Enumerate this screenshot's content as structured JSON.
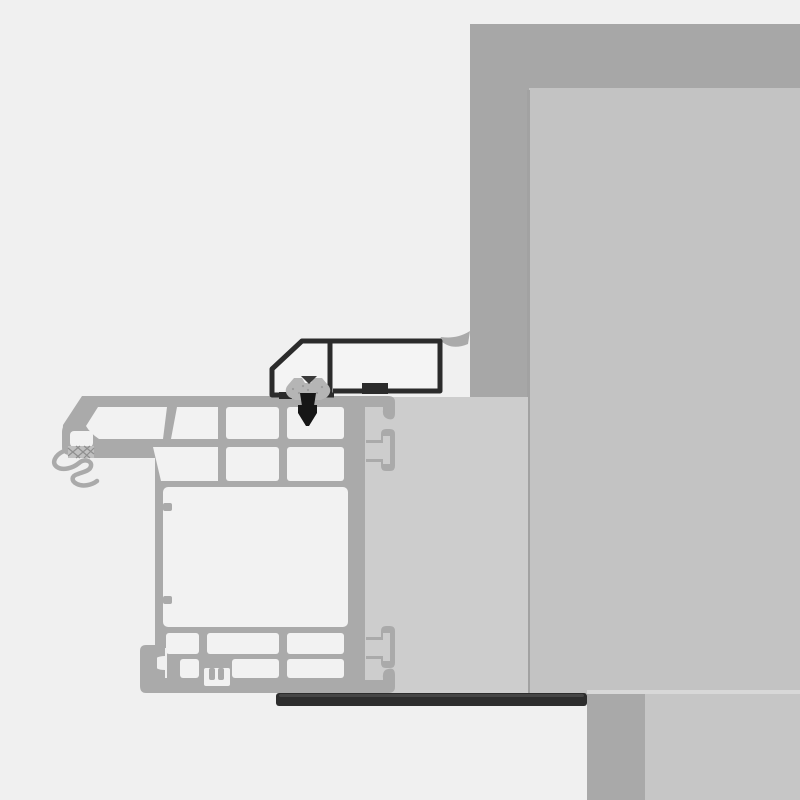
{
  "scene": {
    "name": "window-installation-cross-section",
    "description": "Technical cross-section detail: PVC window frame profile fixed to a wall with flashing profile, compriband gasket, screw fastener and sealing membrane. No text labels are rendered."
  },
  "colors": {
    "background": "#f0f0f0",
    "wall_outer": "#a7a7a7",
    "wall_inner": "#c3c3c3",
    "wall_seam": "#a2a2a2",
    "reveal": "#cdcdcd",
    "lower_column": "#a9a9a9",
    "lower_wall": "#c6c6c6",
    "seam_highlight": "#d8d8d8",
    "frame": "#aaaaaa",
    "chamber": "#f2f2f2",
    "hatch_fill": "#c0c0c0",
    "hatch_line": "#8f8f8f",
    "flashing": "#2b2b2b",
    "flashing_fill": "#f4f4f4",
    "membrane": "#2d2d2d",
    "membrane_top": "#454545",
    "gasket": "#b5b5b5",
    "gasket_fold": "#3a3a3a",
    "gasket_dot": "#9b9b9b",
    "screw": "#161616"
  }
}
